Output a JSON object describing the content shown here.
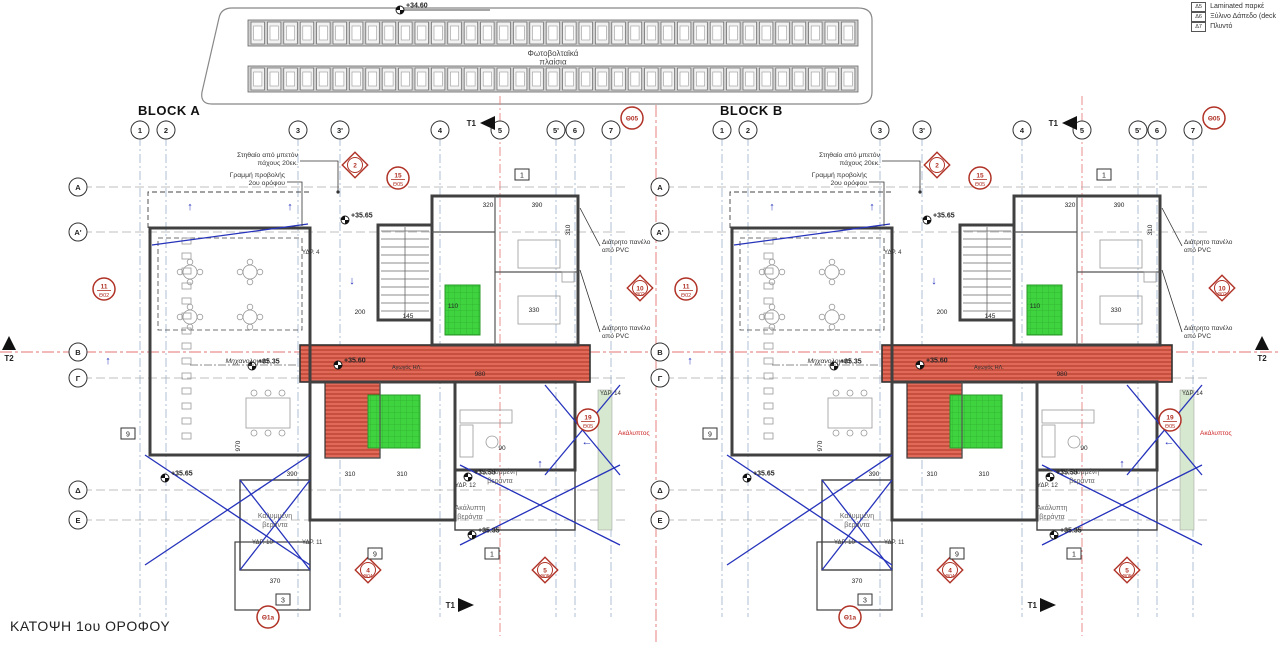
{
  "title": "ΚΑΤΟΨΗ 1ου ΟΡΟΦΟΥ",
  "legend": {
    "items": [
      {
        "code": "Δ5",
        "label": "Laminated παρκέ"
      },
      {
        "code": "Δ6",
        "label": "Ξύλινο Δάπεδο (deck"
      },
      {
        "code": "Δ7",
        "label": "Πλυντό"
      }
    ]
  },
  "pv_array": {
    "level": "+34.60",
    "label_line1": "Φωτοβολταϊκά",
    "label_line2": "πλαίσια"
  },
  "grid": {
    "columns": [
      "1",
      "2",
      "3",
      "3'",
      "4",
      "5",
      "5'",
      "6",
      "7"
    ],
    "rows": [
      "A",
      "A'",
      "B",
      "Γ",
      "Δ",
      "E"
    ]
  },
  "blocks": [
    {
      "name": "BLOCK A"
    },
    {
      "name": "BLOCK B"
    }
  ],
  "section_markers": {
    "t1": "T1",
    "t2": "T2"
  },
  "annotations": {
    "parapet_1": "Στηθαίο από μπετόν",
    "parapet_2": "πάχους 20εκ.",
    "projection_1": "Γραμμή προβολής",
    "projection_2": "2ου ορόφου",
    "pvc_panel_1": "Διάτρητο πανέλο",
    "pvc_panel_2": "από PVC",
    "mechanical": "Μηχανολογικά",
    "duct": "Αγωγός ΗΛ.",
    "covered_veranda_1": "Καλυμμένη",
    "covered_veranda_2": "βεράντα",
    "open_veranda_1": "Ακάλυπτη",
    "open_veranda_2": "βεράντα",
    "open_red": "Ακάλυπτος"
  },
  "levels": [
    "+35.65",
    "+35.35",
    "+35.60",
    "+35.65",
    "+35.55",
    "+35.35"
  ],
  "markers": [
    {
      "num": "15",
      "sheet": "Θ05",
      "shape": "circle"
    },
    {
      "num": "2",
      "sheet": "",
      "shape": "diamond"
    },
    {
      "num": "11",
      "sheet": "Θ02",
      "shape": "circle"
    },
    {
      "num": "10",
      "sheet": "Θ02",
      "shape": "diamond"
    },
    {
      "num": "19",
      "sheet": "Θ05",
      "shape": "circle"
    },
    {
      "num": "4",
      "sheet": "Θ04",
      "shape": "diamond"
    },
    {
      "num": "5",
      "sheet": "Θ05",
      "shape": "diamond"
    },
    {
      "num": "Θ1a",
      "sheet": "",
      "shape": "circle"
    },
    {
      "num": "Θ05",
      "sheet": "",
      "shape": "circle"
    }
  ],
  "square_labels": [
    "9",
    "9",
    "1",
    "3",
    "1"
  ],
  "plumbing_labels": [
    "ΥΔΡ. 4",
    "ΥΔΡ. 14",
    "ΥΔΡ. 12",
    "ΥΔΡ. 10",
    "ΥΔΡ. 11"
  ],
  "dimensions": [
    "320",
    "390",
    "310",
    "330",
    "200",
    "145",
    "110",
    "980",
    "90",
    "390",
    "310",
    "310",
    "970",
    "370"
  ],
  "colors": {
    "wall": "#404040",
    "axis_red": "#e57373",
    "grid_blue": "#9bb0cc",
    "hatch_red": "#c94f3d",
    "room_green": "#3fd43f",
    "cover_blue": "#2633bb",
    "marker_red": "#b03226"
  }
}
